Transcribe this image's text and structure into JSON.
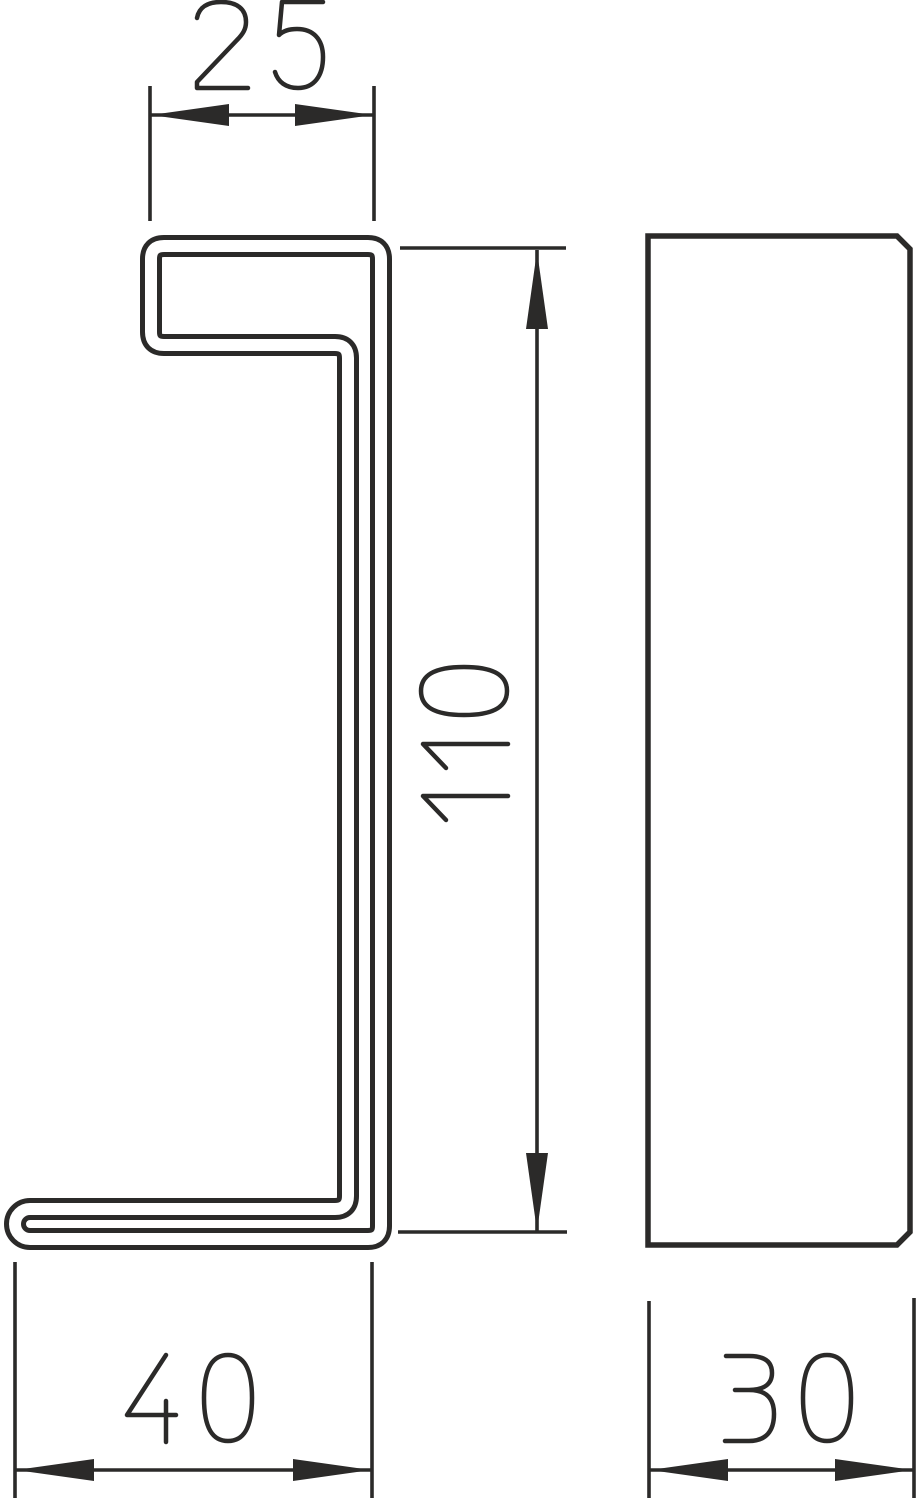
{
  "drawing": {
    "title": "Profile cross-section technical drawing with side view",
    "background_color": "#ffffff",
    "line_color": "#2b2a29",
    "views": {
      "front": {
        "name": "profile-cross-section"
      },
      "side": {
        "name": "side-view-rectangle"
      }
    },
    "dimensions": {
      "top_width": {
        "value": "25",
        "orientation": "horizontal"
      },
      "height": {
        "value": "110",
        "orientation": "vertical"
      },
      "bottom_width": {
        "value": "40",
        "orientation": "horizontal"
      },
      "depth": {
        "value": "30",
        "orientation": "horizontal"
      }
    }
  }
}
